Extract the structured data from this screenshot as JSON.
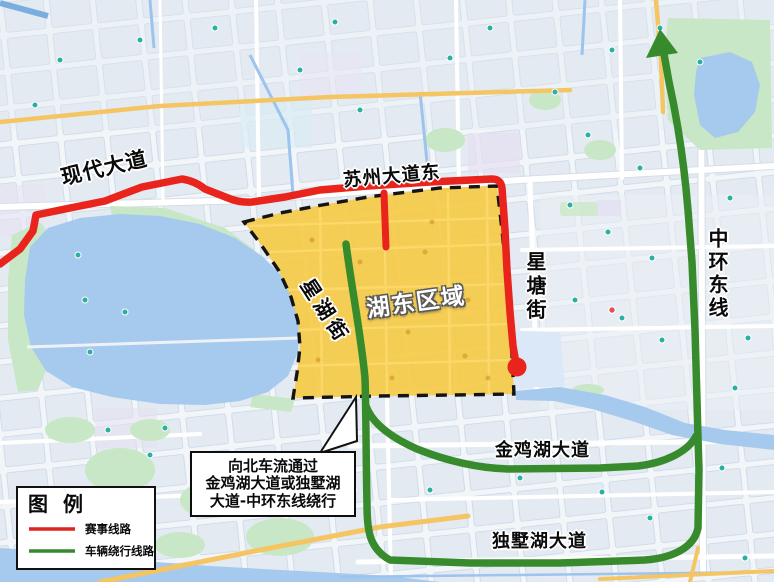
{
  "region": {
    "name": "湖东区域"
  },
  "roads": {
    "xiandai_avenue": "现代大道",
    "suzhou_avenue_east": "苏州大道东",
    "xinghu_street": "星湖街",
    "xingtang_street": "星塘街",
    "zhonghuan_east_line": "中环东线",
    "jinjihu_avenue": "金鸡湖大道",
    "dushuhu_avenue": "独墅湖大道"
  },
  "callout": {
    "line1": "向北车流通过",
    "line2": "金鸡湖大道或独墅湖",
    "line3": "大道-中环东线绕行"
  },
  "legend": {
    "title": "图 例",
    "items": [
      {
        "label": "赛事线路",
        "color": "#e02420"
      },
      {
        "label": "车辆绕行线路",
        "color": "#37892e"
      }
    ]
  },
  "colors": {
    "event_route": "#e8241d",
    "detour_route": "#388b2d",
    "zone_fill": "#f6c83d",
    "zone_border": "#141414",
    "endpoint_dot": "#e8241d"
  },
  "map": {
    "water": "#a6c9ee",
    "park": "#c8e7c6",
    "road_highlight": "#f5c564",
    "canal": "#9cc4ec",
    "poi": "#2ab0a0"
  }
}
